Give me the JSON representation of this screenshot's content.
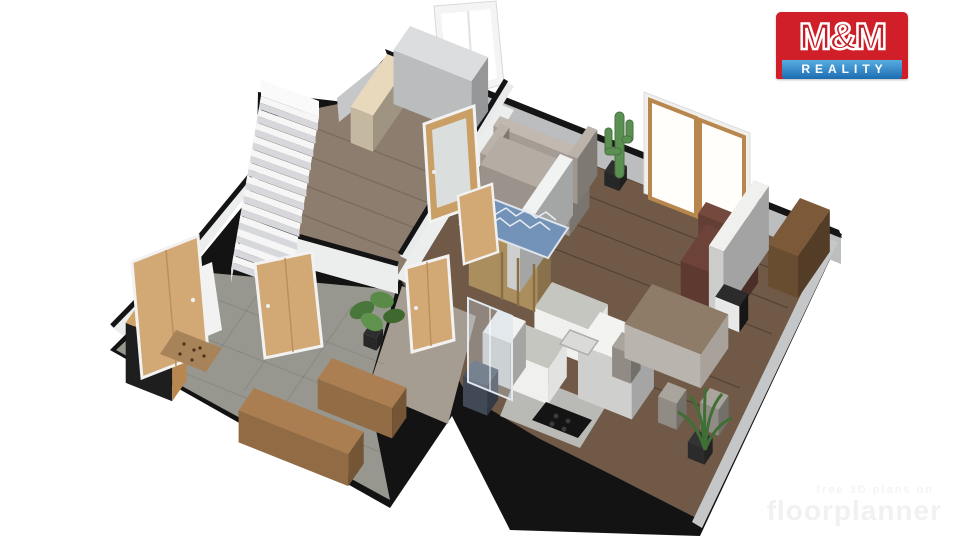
{
  "logo": {
    "top": "M&M",
    "bottom": "REALITY",
    "colors": {
      "red": "#d01f28",
      "blue_top": "#58ade0",
      "blue_bottom": "#1c6cb1",
      "text": "#ffffff"
    }
  },
  "watermark": {
    "line1": "free 3D plans on",
    "line2": "floorplanner"
  },
  "palette": {
    "background": "#ffffff",
    "outer_wall_black": "#131313",
    "exterior_wall_gray": "#bcbdbf",
    "interior_wall_white": "#eceded",
    "wood_floor_left_room": "#8c7d6e",
    "wood_floor_living": "#705a47",
    "tile_floor_hall": "#98978f",
    "carpet_corridor": "#a69d92",
    "door_oak": "#d2a875",
    "sofa_gray": "#b5aca3",
    "rug_blue": "#7392b8",
    "counter_gray": "#c6c6c1",
    "plant_green": "#4f8040",
    "armchair_brown": "#6d4339"
  },
  "scene": {
    "iso_u": [
      0.93,
      0.37
    ],
    "iso_v": [
      -0.55,
      0.8
    ],
    "stairs": {
      "origin": [
        261,
        96
      ],
      "step": [
        -2.3,
        13.3
      ],
      "width": [
        58,
        21
      ],
      "count": 13,
      "tread": "#f6f6f7",
      "riser": "#d7d8db"
    },
    "boxes": [
      {
        "name": "low-chest-bedroom",
        "p": [
          387,
          90
        ],
        "a": 24,
        "b": 66,
        "h": 36,
        "c": "#e8d9bd"
      },
      {
        "name": "dresser-gray",
        "p": [
          410,
          80
        ],
        "a": 84,
        "b": 30,
        "h": 54,
        "c": "#dbdddf"
      },
      {
        "name": "sofa-backrest",
        "p": [
          500,
          170
        ],
        "a": 96,
        "b": 12,
        "h": 54,
        "c": "#c1b8af"
      },
      {
        "name": "sofa-armrest-left",
        "p": [
          500,
          170
        ],
        "a": 10,
        "b": 36,
        "h": 46,
        "c": "#bbb2a9"
      },
      {
        "name": "sofa-seat",
        "p": [
          500,
          172
        ],
        "a": 96,
        "b": 36,
        "h": 36,
        "c": "#b5aca3"
      },
      {
        "name": "sofa-armrest-right",
        "p": [
          588,
          172
        ],
        "a": 10,
        "b": 36,
        "h": 46,
        "c": "#bbb2a9"
      },
      {
        "name": "shelf-oak",
        "p": [
          482,
          266
        ],
        "a": 74,
        "b": 24,
        "h": 56,
        "c": "#c9a76e"
      },
      {
        "name": "sideboard-right-wall",
        "p": [
          800,
          240
        ],
        "a": 32,
        "b": 58,
        "h": 42,
        "c": "#7c5a39"
      },
      {
        "name": "armchair-backrest",
        "p": [
          706,
          258
        ],
        "a": 56,
        "b": 14,
        "h": 56,
        "c": "#74493e"
      },
      {
        "name": "armchair-leather",
        "p": [
          706,
          262
        ],
        "a": 56,
        "b": 46,
        "h": 38,
        "c": "#6d4339"
      },
      {
        "name": "partition-panel",
        "p": [
          754,
          244
        ],
        "a": 16,
        "b": 82,
        "h": 64,
        "c": "#f0f0ef"
      },
      {
        "name": "drawer-unit",
        "p": [
          724,
          310
        ],
        "a": 26,
        "b": 16,
        "h": 26,
        "c": "#2b2b2b",
        "vf": "#e8e8e8",
        "uf": "#161616"
      },
      {
        "name": "kitchen-back-wall",
        "p": [
          560,
          210
        ],
        "a": 14,
        "b": 96,
        "h": 56,
        "c": "#f1f2f2"
      },
      {
        "name": "kitchen-counter-sink",
        "p": [
          552,
          318
        ],
        "a": 60,
        "b": 32,
        "h": 36,
        "c": "#c6c6c1",
        "vf": "#f0f0ee",
        "uf": "#e2e2e0"
      },
      {
        "name": "kitchen-counter-hob",
        "p": [
          524,
          360
        ],
        "a": 46,
        "b": 34,
        "h": 36,
        "c": "#c6c6c1",
        "vf": "#f0f0ee",
        "uf": "#e2e2e0"
      },
      {
        "name": "kitchen-tall-cabinet",
        "p": [
          600,
          366
        ],
        "a": 58,
        "b": 40,
        "h": 54,
        "c": "#f3f3f2"
      },
      {
        "name": "kitchen-cabinet-small",
        "p": [
          498,
          356
        ],
        "a": 30,
        "b": 28,
        "h": 46,
        "c": "#f2f2f1"
      },
      {
        "name": "dining-chair-1",
        "p": [
          642,
          330
        ],
        "a": 20,
        "b": 18,
        "h": 30,
        "c": "#a9a49c"
      },
      {
        "name": "dining-chair-2",
        "p": [
          622,
          362
        ],
        "a": 20,
        "b": 18,
        "h": 30,
        "c": "#a9a49c"
      },
      {
        "name": "dining-table",
        "p": [
          652,
          318
        ],
        "a": 82,
        "b": 50,
        "h": 34,
        "c": "#8e7c68",
        "vf": "#b9b4ad",
        "uf": "#a8a29a"
      },
      {
        "name": "dining-chair-3",
        "p": [
          668,
          408
        ],
        "a": 20,
        "b": 18,
        "h": 26,
        "c": "#a9a49c"
      },
      {
        "name": "dining-chair-4",
        "p": [
          710,
          414
        ],
        "a": 20,
        "b": 18,
        "h": 26,
        "c": "#a9a49c"
      },
      {
        "name": "armchair-navy",
        "p": [
          474,
          390
        ],
        "a": 26,
        "b": 20,
        "h": 30,
        "c": "#4c5565"
      },
      {
        "name": "wardrobe-hall",
        "p": [
          140,
          362
        ],
        "a": 50,
        "b": 26,
        "h": 60,
        "c": "#d2a368",
        "vf": "#1e1e1e",
        "uf": "#b8874f"
      },
      {
        "name": "bench-hall-1",
        "p": [
          332,
          388
        ],
        "a": 80,
        "b": 26,
        "h": 30,
        "c": "#ab7f51"
      },
      {
        "name": "bench-hall-2",
        "p": [
          254,
          420
        ],
        "a": 118,
        "b": 28,
        "h": 32,
        "c": "#aa7e50"
      },
      {
        "name": "cactus-pot",
        "p": [
          612,
          174
        ],
        "a": 16,
        "b": 14,
        "h": 14,
        "c": "#2e2e2e"
      },
      {
        "name": "monstera-pot",
        "p": [
          370,
          336
        ],
        "a": 14,
        "b": 12,
        "h": 12,
        "c": "#2f2f2f"
      },
      {
        "name": "palm-pot",
        "p": [
          696,
          446
        ],
        "a": 18,
        "b": 15,
        "h": 16,
        "c": "#333333"
      }
    ]
  }
}
